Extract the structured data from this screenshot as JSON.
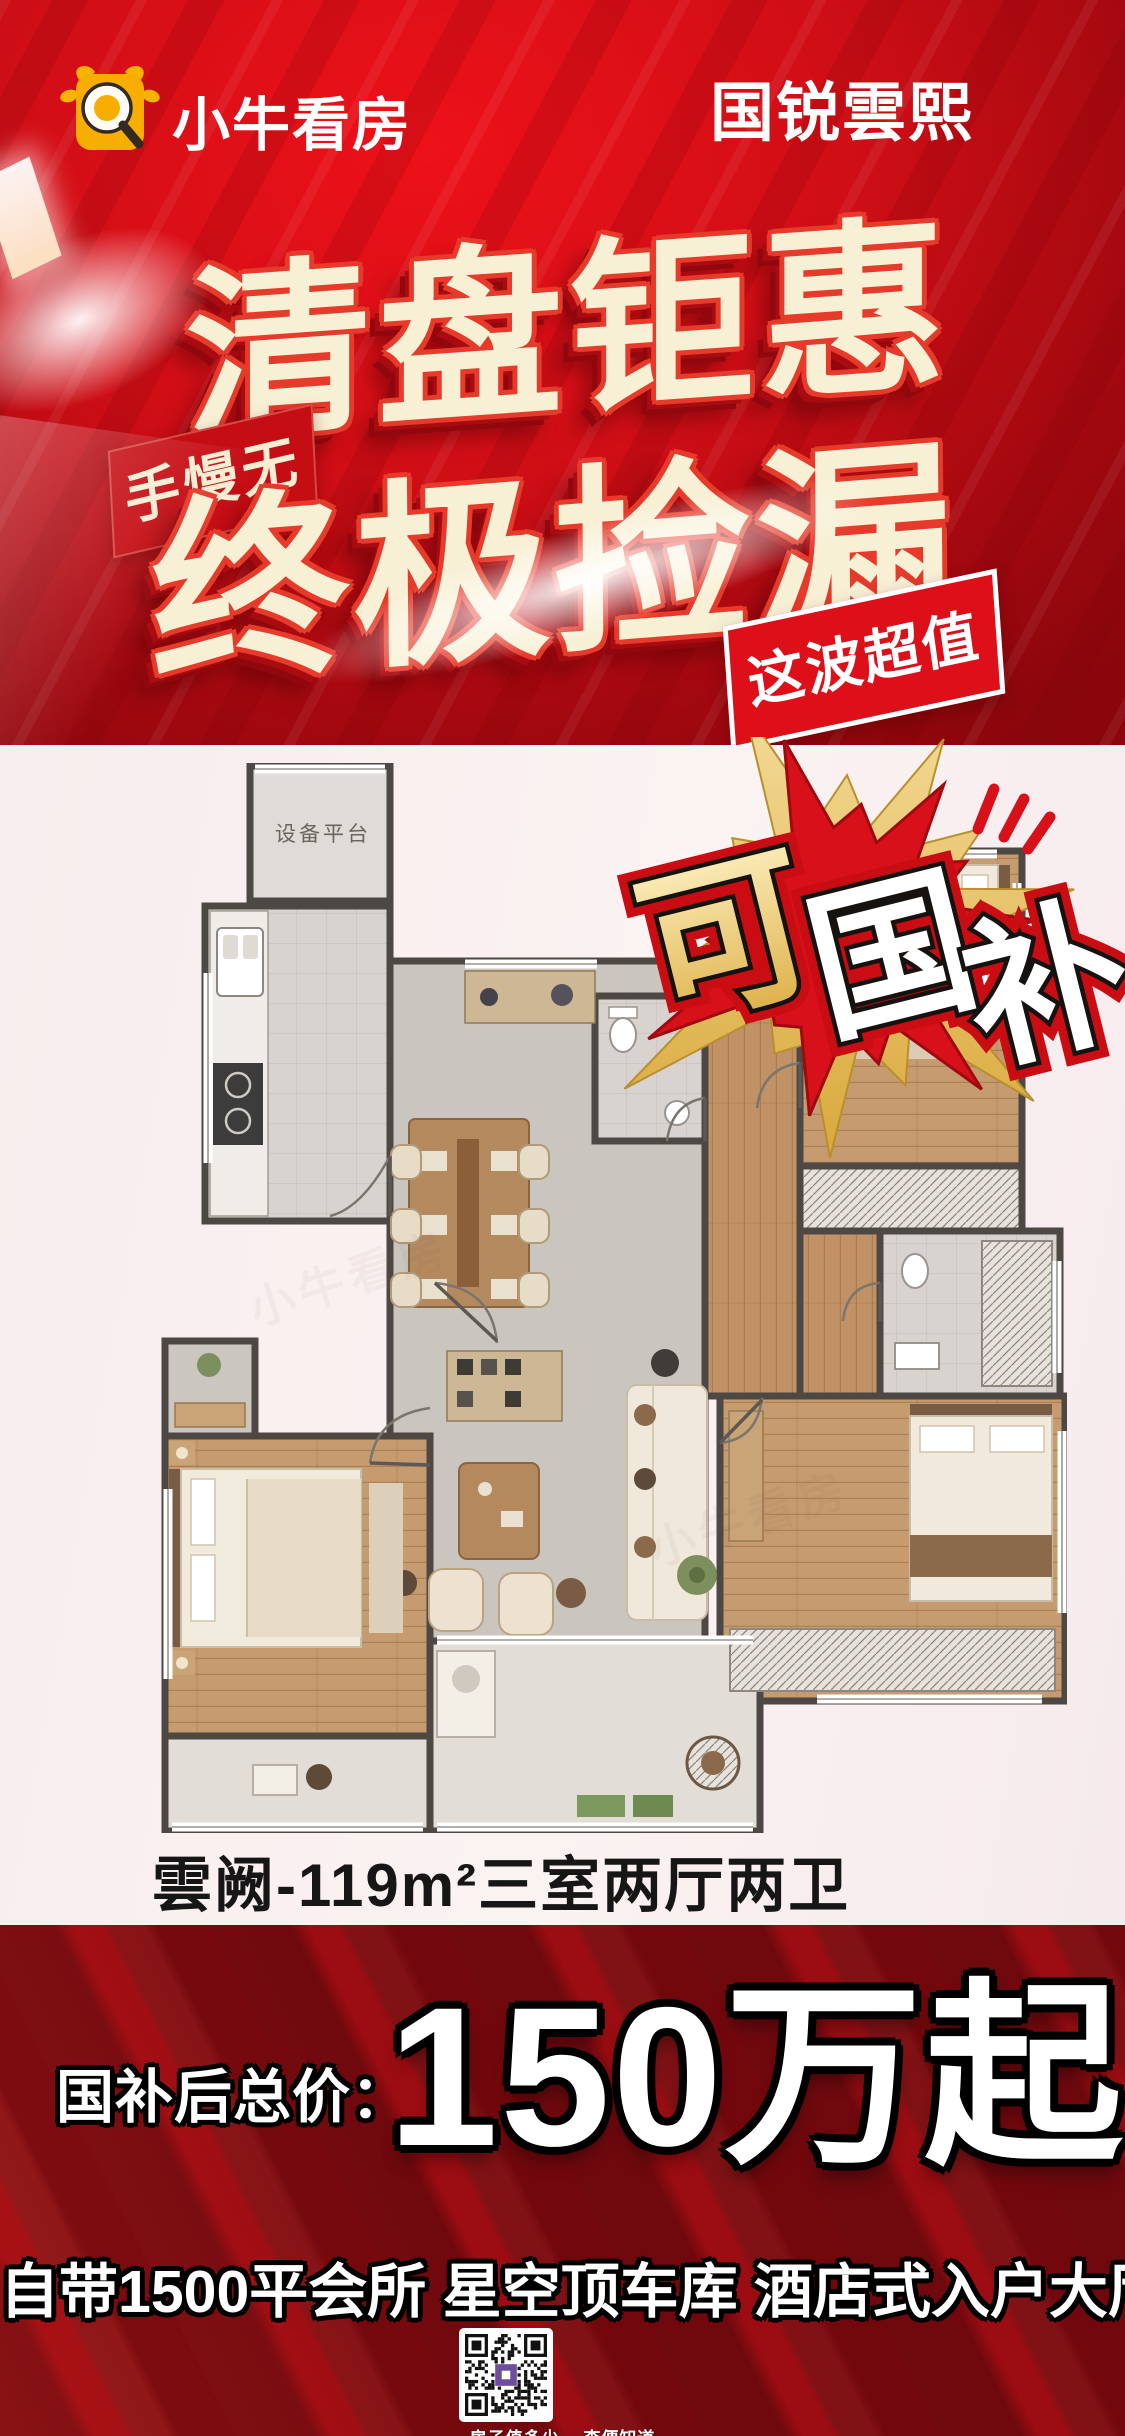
{
  "brand": {
    "name": "小牛看房"
  },
  "header": {
    "project_title": "国锐雲熙"
  },
  "hero": {
    "title_line1": "清盘钜惠",
    "title_line2": "终极捡漏",
    "badge_hurry": "手慢无",
    "badge_value": "这波超值"
  },
  "floorplan": {
    "burst_char1": "可",
    "burst_char2": "国",
    "burst_char3": "补",
    "equipment_label": "设备平台",
    "caption": "雲阙-119m²三室两厅两卫",
    "watermark": "小牛看房"
  },
  "pricing": {
    "label": "国补后总价：",
    "price": "150万起"
  },
  "footer": {
    "headline": "自带1500平会所 星空顶车库 酒店式入户大厅",
    "qr_caption": "房子值多少 一查便知道"
  },
  "colors": {
    "poster_red": "#D40E15",
    "band_red": "#6F090E",
    "cream": "#F8F0D5",
    "brand_gold": "#F7AE00",
    "badge_red": "#C50D14",
    "burst_gold": "#E9C76B"
  }
}
